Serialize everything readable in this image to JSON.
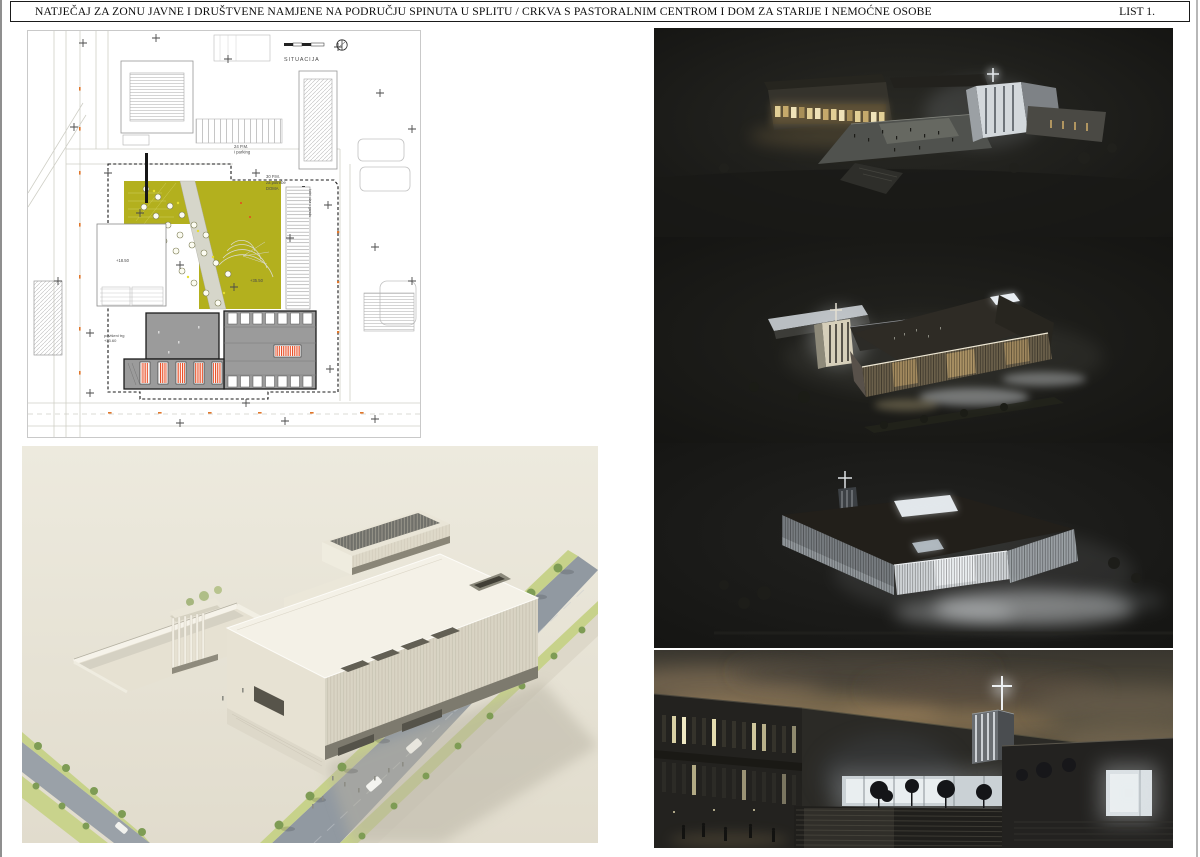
{
  "page": {
    "title": "NATJEČAJ ZA ZONU JAVNE I DRUŠTVENE NAMJENE NA PODRUČJU SPINUTA U  SPLITU / CRKVA S PASTORALNIM CENTROM I DOM ZA STARIJE I NEMOĆNE OSOBE",
    "sheet_label": "LIST 1."
  },
  "site_plan": {
    "caption": "SITUACIJA",
    "labels": {
      "parking_north_line1": "24 P.M.",
      "parking_north_line2": "i parking",
      "parking_dom_line1": "30 P.M.",
      "parking_dom_line2": "za potrebe",
      "parking_dom_line3": "DOMA",
      "plaza_line1": "povišeni trg",
      "plaza_line2": "+33.60",
      "elev_plaza": "+18.50",
      "elev_green": "+35.50",
      "garage_ramp": "kolni ulaz u garažu"
    },
    "colors": {
      "greenspace": "#b3b01e",
      "accent_red": "#e8491f",
      "building_gray": "#9b9b9b"
    }
  },
  "figures": {
    "site_plan": "site-plan-drawing",
    "day": "daytime-aerial-render",
    "night1": "night-aerial-render-1",
    "night2": "night-aerial-render-2",
    "night3": "night-aerial-render-3",
    "dusk": "dusk-entrance-render"
  }
}
